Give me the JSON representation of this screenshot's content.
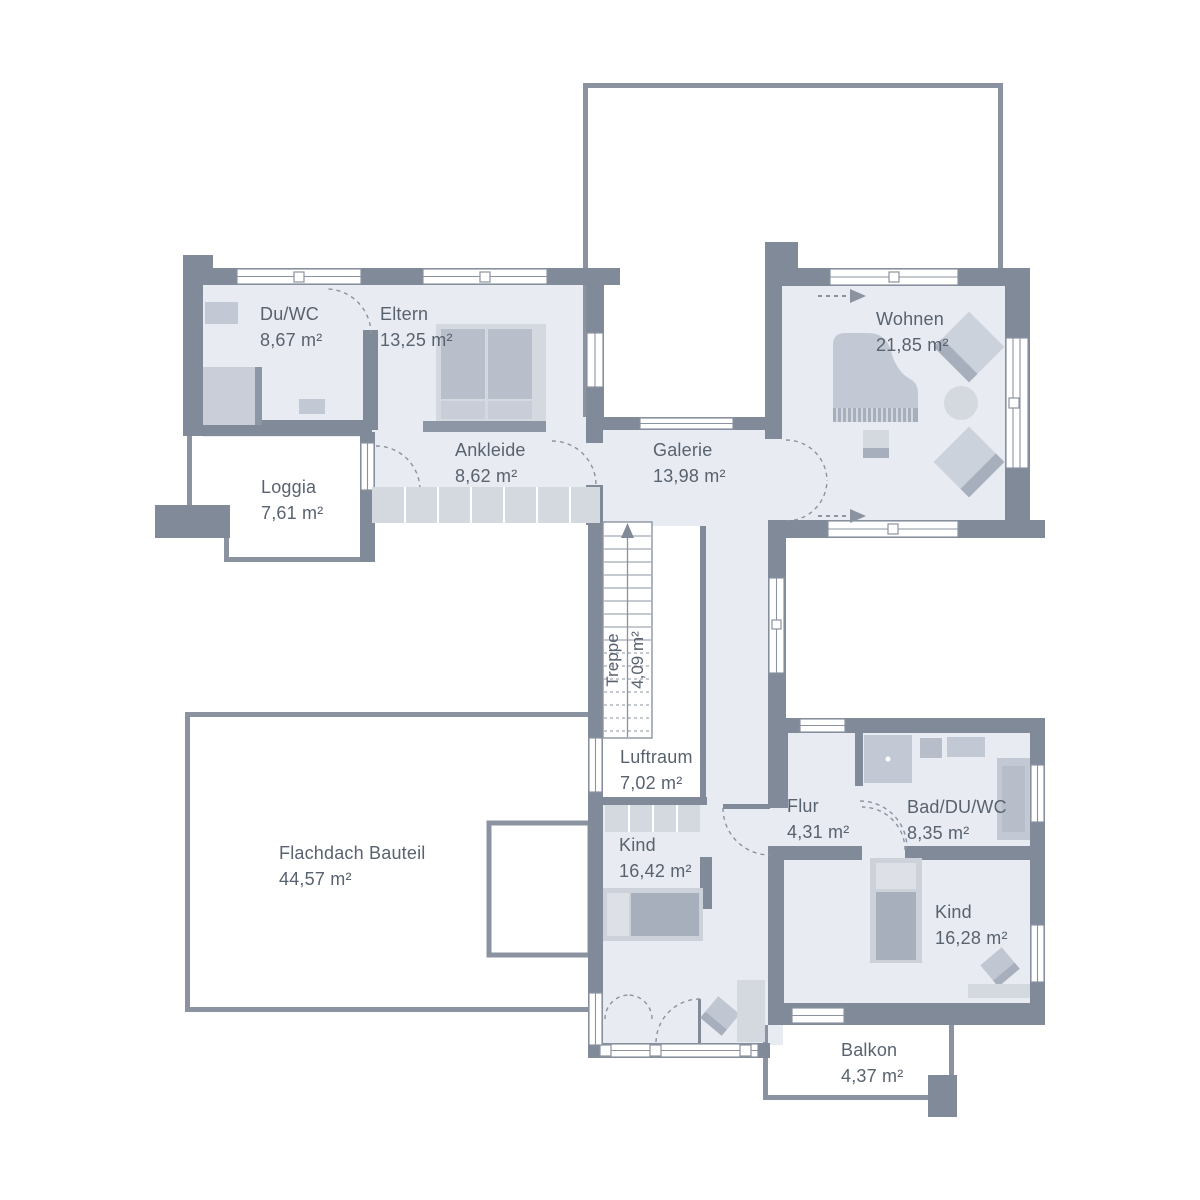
{
  "title": "Obergeschoss Grundriss",
  "rooms": {
    "duwc": {
      "name": "Du/WC",
      "area": "8,67 m²"
    },
    "eltern": {
      "name": "Eltern",
      "area": "13,25 m²"
    },
    "ankleide": {
      "name": "Ankleide",
      "area": "8,62 m²"
    },
    "loggia": {
      "name": "Loggia",
      "area": "7,61 m²"
    },
    "galerie": {
      "name": "Galerie",
      "area": "13,98 m²"
    },
    "wohnen": {
      "name": "Wohnen",
      "area": "21,85 m²"
    },
    "treppe": {
      "name": "Treppe",
      "area": "4,09 m²"
    },
    "luftraum": {
      "name": "Luftraum",
      "area": "7,02 m²"
    },
    "flachdach": {
      "name": "Flachdach Bauteil",
      "area": "44,57 m²"
    },
    "kind1": {
      "name": "Kind",
      "area": "16,42 m²"
    },
    "flur": {
      "name": "Flur",
      "area": "4,31 m²"
    },
    "bad": {
      "name": "Bad/DU/WC",
      "area": "8,35 m²"
    },
    "kind2": {
      "name": "Kind",
      "area": "16,28 m²"
    },
    "balkon": {
      "name": "Balkon",
      "area": "4,37 m²"
    }
  },
  "colors": {
    "wall": "#808a98",
    "outline": "#8b93a1",
    "floor": "#e8ebf1",
    "furniture_light": "#d4d9e0",
    "furniture_mid": "#c3c9d4",
    "furniture_dark": "#a7afbd",
    "text": "#59626f"
  }
}
